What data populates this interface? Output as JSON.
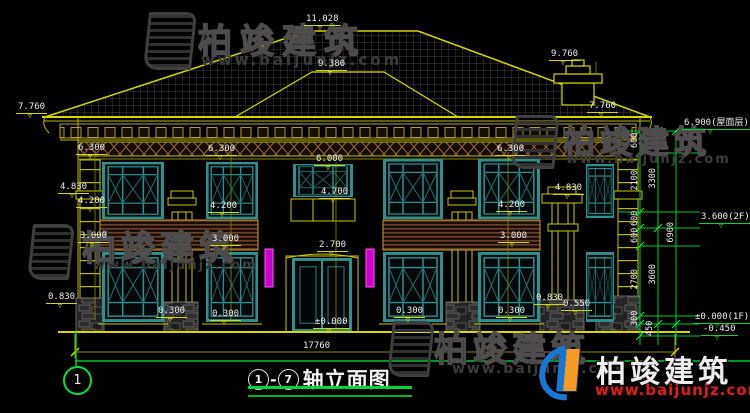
{
  "drawing": {
    "axis_bubble": "1",
    "title": {
      "from": "1",
      "dash": "-",
      "to": "7",
      "label": "轴立面图"
    },
    "levels": [
      {
        "text": "11.028",
        "x": 304,
        "y": 15
      },
      {
        "text": "9.380",
        "x": 316,
        "y": 60
      },
      {
        "text": "9.760",
        "x": 549,
        "y": 50
      },
      {
        "text": "7.760",
        "x": 16,
        "y": 103
      },
      {
        "text": "7.760",
        "x": 587,
        "y": 102
      },
      {
        "text": "6.300",
        "x": 76,
        "y": 144
      },
      {
        "text": "6.300",
        "x": 206,
        "y": 145
      },
      {
        "text": "6.300",
        "x": 495,
        "y": 145
      },
      {
        "text": "6.000",
        "x": 314,
        "y": 155
      },
      {
        "text": "4.830",
        "x": 58,
        "y": 183
      },
      {
        "text": "4.830",
        "x": 553,
        "y": 184
      },
      {
        "text": "4.700",
        "x": 319,
        "y": 188
      },
      {
        "text": "4.200",
        "x": 76,
        "y": 197
      },
      {
        "text": "4.200",
        "x": 208,
        "y": 202
      },
      {
        "text": "4.200",
        "x": 496,
        "y": 201
      },
      {
        "text": "3.000",
        "x": 78,
        "y": 232
      },
      {
        "text": "3.000",
        "x": 210,
        "y": 235
      },
      {
        "text": "3.000",
        "x": 498,
        "y": 232
      },
      {
        "text": "2.700",
        "x": 317,
        "y": 241
      },
      {
        "text": "0.830",
        "x": 46,
        "y": 293
      },
      {
        "text": "0.830",
        "x": 534,
        "y": 294
      },
      {
        "text": "0.550",
        "x": 561,
        "y": 300
      },
      {
        "text": "0.300",
        "x": 156,
        "y": 307
      },
      {
        "text": "0.300",
        "x": 210,
        "y": 310
      },
      {
        "text": "0.300",
        "x": 394,
        "y": 307
      },
      {
        "text": "0.300",
        "x": 496,
        "y": 307
      },
      {
        "text": "±0.000",
        "x": 313,
        "y": 318
      }
    ],
    "right_levels": [
      {
        "text": "6.900(屋面层)",
        "x": 682,
        "y": 119
      },
      {
        "text": "3.600(2F)",
        "x": 699,
        "y": 213
      },
      {
        "text": "±0.000(1F)",
        "x": 693,
        "y": 313
      },
      {
        "text": "-0.450",
        "x": 701,
        "y": 325
      }
    ],
    "vdims": [
      {
        "text": "600",
        "x": 617,
        "y": 136
      },
      {
        "text": "2100",
        "x": 617,
        "y": 176
      },
      {
        "text": "600",
        "x": 617,
        "y": 214
      },
      {
        "text": "600",
        "x": 617,
        "y": 231
      },
      {
        "text": "2700",
        "x": 617,
        "y": 275
      },
      {
        "text": "300",
        "x": 617,
        "y": 314
      },
      {
        "text": "450",
        "x": 632,
        "y": 324
      },
      {
        "text": "3300",
        "x": 635,
        "y": 174
      },
      {
        "text": "3600",
        "x": 635,
        "y": 270
      },
      {
        "text": "6900",
        "x": 653,
        "y": 228
      }
    ],
    "hdims": [
      {
        "text": "17760",
        "x": 303,
        "y": 342
      }
    ]
  },
  "watermark": {
    "brand": "柏竣建筑",
    "url": "www.baijunjz.com"
  },
  "colors": {
    "line_yellow": "#d6d600",
    "accent_green": "#00d53a",
    "window_teal": "#2f8f8f",
    "magenta": "#cc00cc",
    "brand_red": "#d42020",
    "logo_blue": "#1976d2",
    "logo_orange": "#f59a23"
  }
}
